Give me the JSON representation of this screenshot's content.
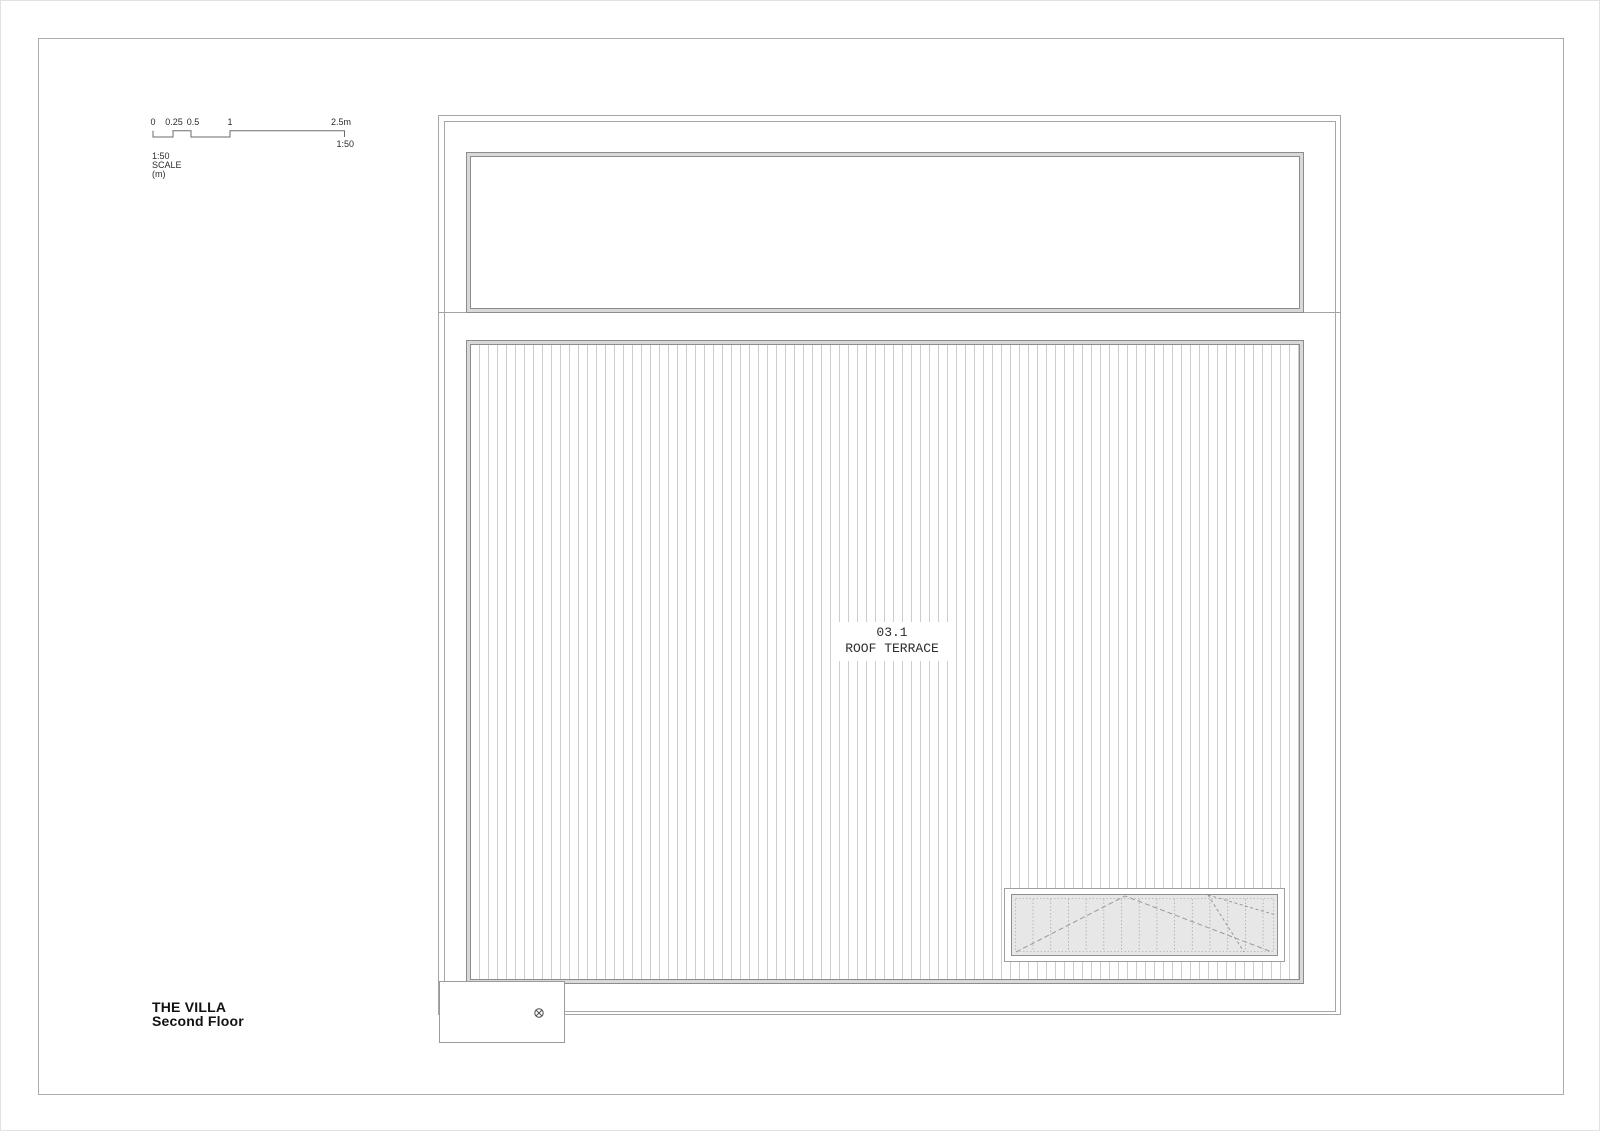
{
  "sheet": {
    "title": "THE VILLA",
    "subtitle": "Second Floor"
  },
  "scale_bar": {
    "ticks": [
      "0",
      "0.25",
      "0.5",
      "1",
      "2.5m"
    ],
    "ratio_label": "1:50",
    "caption": "1:50 SCALE (m)"
  },
  "plan": {
    "room": {
      "number": "03.1",
      "name": "ROOF TERRACE"
    },
    "symbols": {
      "drain": "circle-cross"
    }
  },
  "colors": {
    "paper": "#ffffff",
    "sheet_border": "#ababab",
    "wall_line": "#a6a6a6",
    "detail_line": "#8c8c8c",
    "hatch_line": "#cdcdcd",
    "skylight_fill": "#e7e7e7",
    "text_primary": "#111111",
    "text_annotation": "#2d2d2d"
  }
}
